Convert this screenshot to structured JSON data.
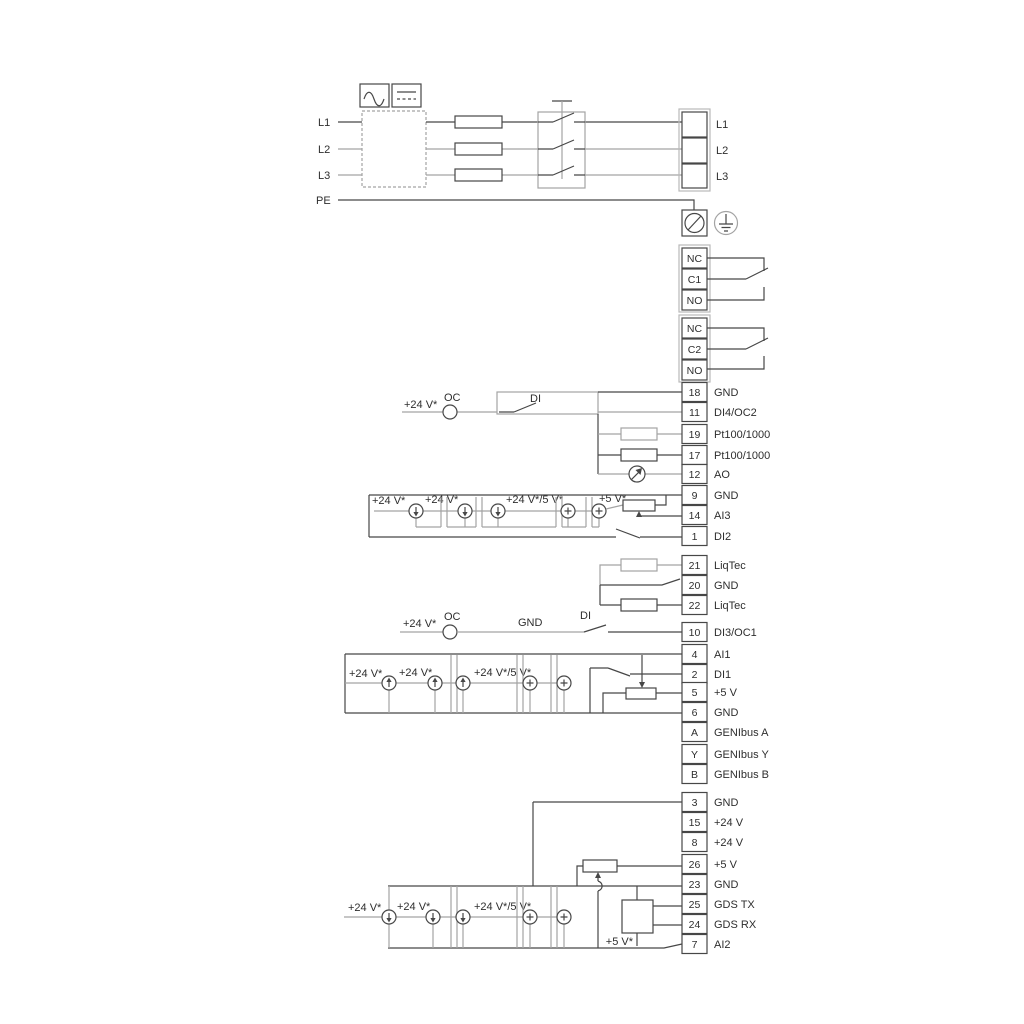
{
  "power": {
    "inputs": [
      "L1",
      "L2",
      "L3",
      "PE"
    ],
    "outputs": [
      "L1",
      "L2",
      "L3"
    ]
  },
  "relays": [
    {
      "contacts": [
        "NC",
        "C1",
        "NO"
      ]
    },
    {
      "contacts": [
        "NC",
        "C2",
        "NO"
      ]
    }
  ],
  "terminals": [
    {
      "num": "18",
      "label": "GND"
    },
    {
      "num": "11",
      "label": "DI4/OC2"
    },
    {
      "num": "19",
      "label": "Pt100/1000"
    },
    {
      "num": "17",
      "label": "Pt100/1000"
    },
    {
      "num": "12",
      "label": "AO"
    },
    {
      "num": "9",
      "label": "GND"
    },
    {
      "num": "14",
      "label": "AI3"
    },
    {
      "num": "1",
      "label": "DI2"
    },
    {
      "num": "21",
      "label": "LiqTec"
    },
    {
      "num": "20",
      "label": "GND"
    },
    {
      "num": "22",
      "label": "LiqTec"
    },
    {
      "num": "10",
      "label": "DI3/OC1"
    },
    {
      "num": "4",
      "label": "AI1"
    },
    {
      "num": "2",
      "label": "DI1"
    },
    {
      "num": "5",
      "label": "+5 V"
    },
    {
      "num": "6",
      "label": "GND"
    },
    {
      "num": "A",
      "label": "GENIbus A"
    },
    {
      "num": "Y",
      "label": "GENIbus Y"
    },
    {
      "num": "B",
      "label": "GENIbus B"
    },
    {
      "num": "3",
      "label": "GND"
    },
    {
      "num": "15",
      "label": "+24 V"
    },
    {
      "num": "8",
      "label": "+24 V"
    },
    {
      "num": "26",
      "label": "+5 V"
    },
    {
      "num": "23",
      "label": "GND"
    },
    {
      "num": "25",
      "label": "GDS TX"
    },
    {
      "num": "24",
      "label": "GDS RX"
    },
    {
      "num": "7",
      "label": "AI2"
    }
  ],
  "labels": {
    "oc": "OC",
    "di": "DI",
    "gnd": "GND",
    "v24": "+24 V*",
    "v24_5": "+24 V*/5 V*",
    "v5": "+5 V*"
  },
  "colors": {
    "wire_dark": "#474747",
    "wire_gray": "#a3a3a3",
    "text": "#2e2e2e"
  }
}
